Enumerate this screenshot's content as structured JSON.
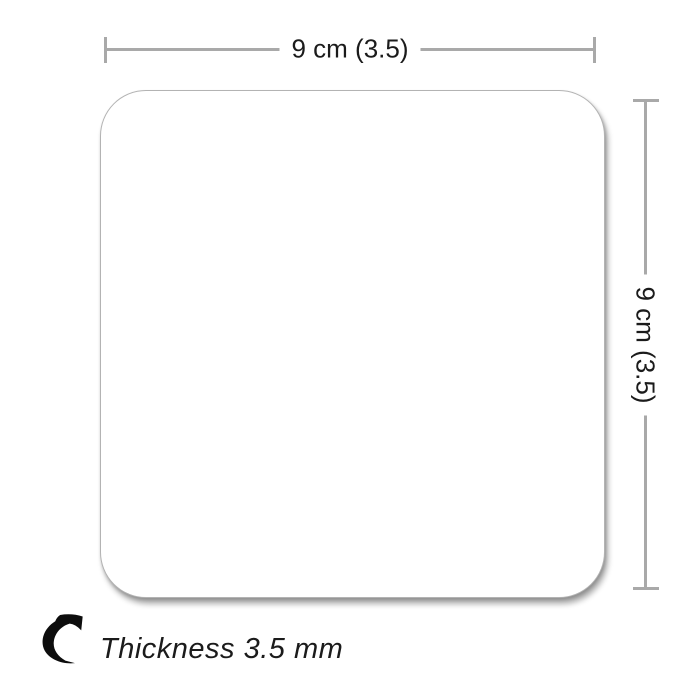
{
  "diagram": {
    "title": "coaster-dimension-diagram",
    "width_label": "9 cm (3.5)",
    "height_label": "9 cm (3.5)",
    "thickness_label": "Thickness 3.5 mm"
  },
  "icons": {
    "thickness_arrow": "curved-arrow-icon"
  },
  "colors": {
    "background": "#ffffff",
    "dimension_line": "#a9a9a9",
    "label_text": "#1b1b1b",
    "coaster_fill": "#ffffff",
    "coaster_border": "#b3b3b3",
    "arrow_icon": "#0d0d0d"
  }
}
